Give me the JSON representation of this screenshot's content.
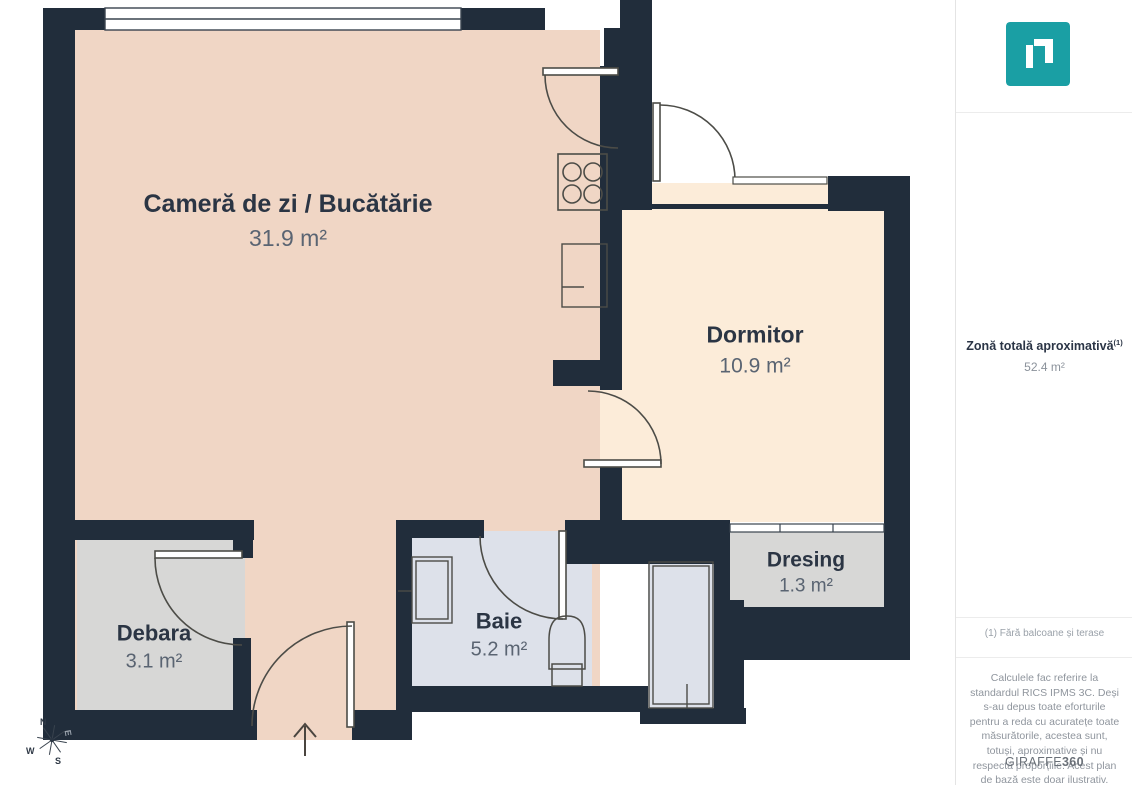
{
  "plan": {
    "rooms": [
      {
        "name": "Cameră de zi / Bucătărie",
        "area": "31.9 m²"
      },
      {
        "name": "Dormitor",
        "area": "10.9 m²"
      },
      {
        "name": "Dresing",
        "area": "1.3 m²"
      },
      {
        "name": "Debara",
        "area": "3.1 m²"
      },
      {
        "name": "Baie",
        "area": "5.2 m²"
      }
    ],
    "compass": {
      "north": "N",
      "east": "E",
      "south": "S",
      "west": "W"
    },
    "colors": {
      "wall": "#212d3b",
      "living": "#f0d6c5",
      "bedroom": "#fcecd9",
      "storage_gray": "#d7d7d6",
      "bathroom": "#dde1ea",
      "brand_teal": "#1a9fa4"
    }
  },
  "sidebar": {
    "total_label": "Zonă totală aproximativă",
    "total_sup": "(1)",
    "total_value": "52.4 m²",
    "footnote": "(1) Fără balcoane și terase",
    "disclaimer": "Calculele fac referire la standardul RICS IPMS 3C. Deși s-au depus toate eforturile pentru a reda cu acuratețe toate măsurătorile, acestea sunt, totuși, aproximative și nu respectă proporțiile. Acest plan de bază este doar ilustrativ.",
    "brand": {
      "name": "GIRAFFE",
      "suffix": "360"
    }
  }
}
